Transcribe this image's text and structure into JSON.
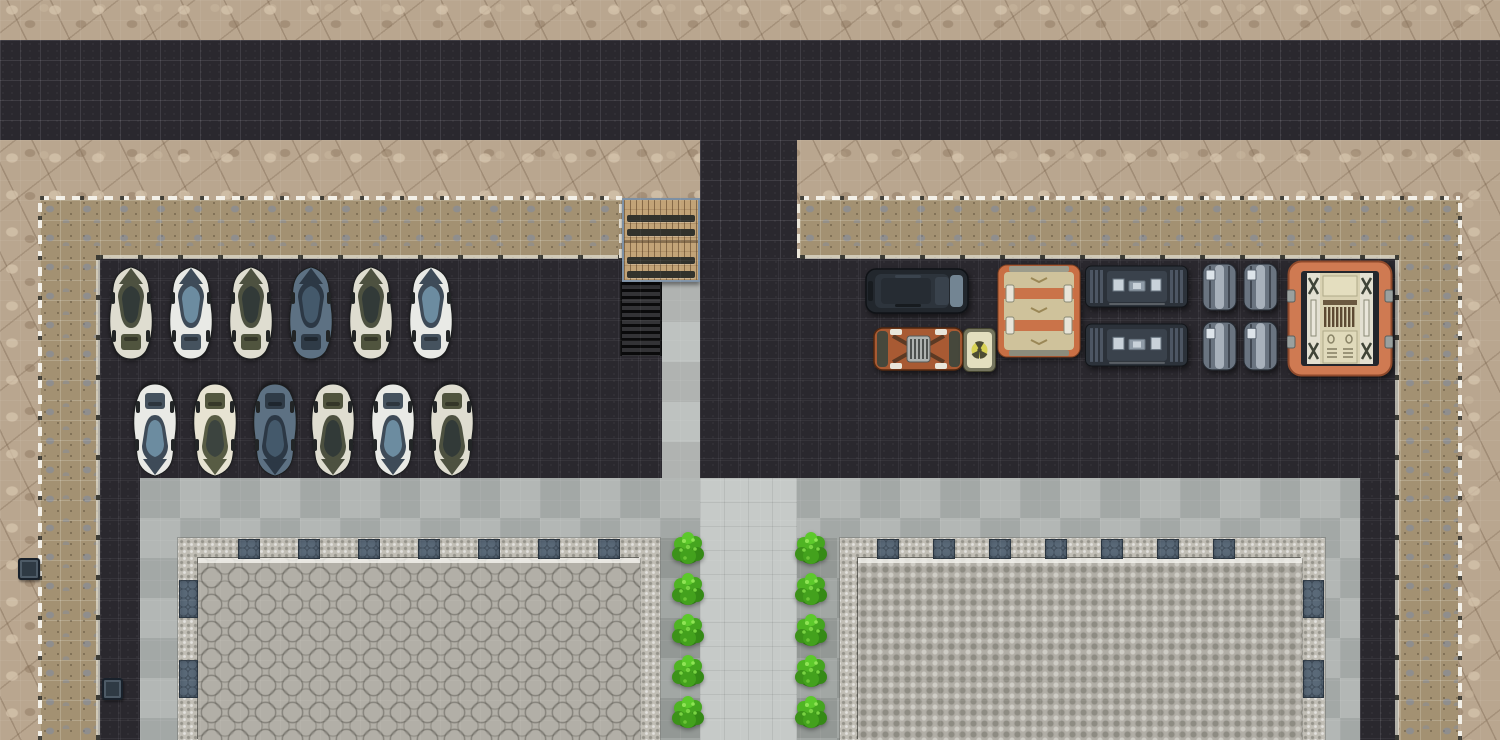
{
  "meta": {
    "view": "top-down-tile-map",
    "canvas_w": 1500,
    "canvas_h": 740,
    "tile_px": 20
  },
  "palette": {
    "rock": "#b9a68f",
    "asphalt": "#2a282e",
    "gravel": "#a39172",
    "plaza_concrete": "#acb1af",
    "walkway": "#c6cac8",
    "bush_strip": "#9ca29e",
    "deck_border": "#c1beb5",
    "hex_platform": "#b2afa7",
    "accent_tile": "#5a6978",
    "fence_white": "#f3f0e8",
    "bridge_wood": "#c2a377",
    "bush_green": "#46a81f",
    "car_themes": {
      "olive": {
        "body": "#dfddd0",
        "nose": "#4d5140",
        "canopy": "#4d5140",
        "glass": "#323a38",
        "rear": "#50543e"
      },
      "white_blue": {
        "body": "#e9eae6",
        "nose": "#3e4b58",
        "canopy": "#3e4b58",
        "glass": "#6c8ca0",
        "rear": "#45525e"
      },
      "dark_blue": {
        "body": "#5d7183",
        "nose": "#2c3845",
        "canopy": "#2c3845",
        "glass": "#44596b",
        "rear": "#2f3b47"
      },
      "cream_olive": {
        "body": "#e7e3d2",
        "nose": "#585c44",
        "canopy": "#585c44",
        "glass": "#3c443f",
        "rear": "#53573f"
      }
    },
    "van": {
      "body": "#22272d",
      "panel": "#2d343c",
      "glass": "#8fa6b6"
    },
    "cart": {
      "body": "#a85a33",
      "caps": "#46483c",
      "grille": "#aeb2b0",
      "pads": "#e9e6da"
    },
    "crate": {
      "frame": "#76765f",
      "face": "#e3dfbf",
      "symbol": "#d6d049"
    },
    "canvas_container": {
      "frame": "#c96f44",
      "canvas": "#cfc29b",
      "buckle": "#e8e4d8"
    },
    "trailer": {
      "body": "#2c323a",
      "ribs": "#4d5663",
      "panel": "#3a424c",
      "window": "#c9d2da"
    },
    "barrels": {
      "body": "#6a7480",
      "sheen": "#e6eef6",
      "port": "#dde4ea"
    },
    "orange_container": {
      "frame": "#cf7a52",
      "inner": "#23262c",
      "panel": "#d9d2b2",
      "rail": "#e3e0d2",
      "ribs": "#5d4a33",
      "tab": "#9aa09e"
    }
  },
  "terrain": [
    {
      "name": "rock-terrain",
      "surface": "rock",
      "x": 0,
      "y": 0,
      "w": 1500,
      "h": 740
    },
    {
      "name": "top-road",
      "surface": "asphalt",
      "x": 0,
      "y": 40,
      "w": 1500,
      "h": 100
    },
    {
      "name": "center-road",
      "surface": "asphalt",
      "x": 700,
      "y": 140,
      "w": 97,
      "h": 120
    },
    {
      "name": "gravel-path-top-left",
      "surface": "gravel",
      "x": 40,
      "y": 200,
      "w": 582,
      "h": 58
    },
    {
      "name": "gravel-path-top-right",
      "surface": "gravel",
      "x": 800,
      "y": 200,
      "w": 660,
      "h": 58
    },
    {
      "name": "gravel-path-left",
      "surface": "gravel",
      "x": 40,
      "y": 200,
      "w": 58,
      "h": 540
    },
    {
      "name": "gravel-path-right",
      "surface": "gravel",
      "x": 1400,
      "y": 200,
      "w": 58,
      "h": 540
    },
    {
      "name": "compound-asphalt",
      "surface": "asphalt",
      "x": 98,
      "y": 258,
      "w": 1300,
      "h": 220
    },
    {
      "name": "asphalt-margin-left",
      "surface": "asphalt",
      "x": 98,
      "y": 478,
      "w": 42,
      "h": 262
    },
    {
      "name": "asphalt-margin-right",
      "surface": "asphalt",
      "x": 1360,
      "y": 478,
      "w": 38,
      "h": 262
    },
    {
      "name": "plaza-concrete",
      "surface": "plaza",
      "x": 140,
      "y": 478,
      "w": 1220,
      "h": 262
    },
    {
      "name": "central-walkway",
      "surface": "walkway",
      "x": 700,
      "y": 478,
      "w": 97,
      "h": 262
    },
    {
      "name": "stair-landing",
      "surface": "landing",
      "x": 662,
      "y": 282,
      "w": 38,
      "h": 196
    },
    {
      "name": "stairs-down",
      "surface": "stairs",
      "x": 620,
      "y": 282,
      "w": 42,
      "h": 74
    },
    {
      "name": "planter-strip-left",
      "surface": "bushstrip",
      "x": 660,
      "y": 538,
      "w": 40,
      "h": 202
    },
    {
      "name": "planter-strip-right",
      "surface": "bushstrip",
      "x": 797,
      "y": 538,
      "w": 43,
      "h": 202
    },
    {
      "name": "hex-deck-left",
      "surface": "deckborder",
      "x": 178,
      "y": 538,
      "w": 482,
      "h": 202
    },
    {
      "name": "hex-platform-left",
      "surface": "hexplatform",
      "x": 198,
      "y": 558,
      "w": 442,
      "h": 182
    },
    {
      "name": "hex-deck-right",
      "surface": "deckborder",
      "x": 840,
      "y": 538,
      "w": 485,
      "h": 202
    },
    {
      "name": "hex-platform-right",
      "surface": "dotplatform",
      "x": 858,
      "y": 558,
      "w": 444,
      "h": 182
    }
  ],
  "fences": {
    "outer": [
      {
        "dir": "h",
        "x": 40,
        "y": 196,
        "len": 582
      },
      {
        "dir": "h",
        "x": 800,
        "y": 196,
        "len": 660
      },
      {
        "dir": "v",
        "x": 38,
        "y": 196,
        "len": 544
      },
      {
        "dir": "v",
        "x": 1458,
        "y": 196,
        "len": 544
      }
    ],
    "inner": [
      {
        "dir": "h",
        "x": 98,
        "y": 255,
        "len": 524
      },
      {
        "dir": "h",
        "x": 800,
        "y": 255,
        "len": 598
      },
      {
        "dir": "v",
        "x": 96,
        "y": 255,
        "len": 485
      },
      {
        "dir": "v",
        "x": 1395,
        "y": 255,
        "len": 485
      }
    ],
    "gates": [
      {
        "x": 619,
        "y": 198,
        "len": 60
      },
      {
        "x": 797,
        "y": 198,
        "len": 60
      }
    ]
  },
  "bridge": {
    "x": 622,
    "y": 198,
    "w": 78,
    "h": 84,
    "bars_rel_y": [
      15,
      29,
      57,
      71
    ],
    "split_rel_y": 40
  },
  "deck_accents": [
    {
      "x": 238,
      "y": 539,
      "w": 22,
      "h": 20
    },
    {
      "x": 298,
      "y": 539,
      "w": 22,
      "h": 20
    },
    {
      "x": 358,
      "y": 539,
      "w": 22,
      "h": 20
    },
    {
      "x": 418,
      "y": 539,
      "w": 22,
      "h": 20
    },
    {
      "x": 478,
      "y": 539,
      "w": 22,
      "h": 20
    },
    {
      "x": 538,
      "y": 539,
      "w": 22,
      "h": 20
    },
    {
      "x": 598,
      "y": 539,
      "w": 22,
      "h": 20
    },
    {
      "x": 179,
      "y": 580,
      "w": 19,
      "h": 38
    },
    {
      "x": 179,
      "y": 660,
      "w": 19,
      "h": 38
    },
    {
      "x": 877,
      "y": 539,
      "w": 22,
      "h": 20
    },
    {
      "x": 933,
      "y": 539,
      "w": 22,
      "h": 20
    },
    {
      "x": 989,
      "y": 539,
      "w": 22,
      "h": 20
    },
    {
      "x": 1045,
      "y": 539,
      "w": 22,
      "h": 20
    },
    {
      "x": 1101,
      "y": 539,
      "w": 22,
      "h": 20
    },
    {
      "x": 1157,
      "y": 539,
      "w": 22,
      "h": 20
    },
    {
      "x": 1213,
      "y": 539,
      "w": 22,
      "h": 20
    },
    {
      "x": 1303,
      "y": 580,
      "w": 21,
      "h": 38
    },
    {
      "x": 1303,
      "y": 660,
      "w": 21,
      "h": 38
    }
  ],
  "props": [
    {
      "name": "utility-box",
      "x": 18,
      "y": 558,
      "w": 22,
      "h": 22
    },
    {
      "name": "utility-box",
      "x": 102,
      "y": 678,
      "w": 21,
      "h": 22
    }
  ],
  "vegetation": {
    "bush_columns_x": [
      672,
      795
    ],
    "bush_rows_y": [
      531,
      572,
      613,
      654,
      695
    ],
    "bush_w": 32,
    "bush_h": 36
  },
  "vehicles": {
    "car_w": 52,
    "car_h": 97,
    "car_rows": [
      {
        "facing": "up",
        "y": 264,
        "cars": [
          {
            "x": 105,
            "theme": "olive"
          },
          {
            "x": 165,
            "theme": "white_blue"
          },
          {
            "x": 225,
            "theme": "olive"
          },
          {
            "x": 285,
            "theme": "dark_blue"
          },
          {
            "x": 345,
            "theme": "olive"
          },
          {
            "x": 405,
            "theme": "white_blue"
          }
        ]
      },
      {
        "facing": "down",
        "y": 382,
        "cars": [
          {
            "x": 129,
            "theme": "white_blue"
          },
          {
            "x": 189,
            "theme": "cream_olive"
          },
          {
            "x": 249,
            "theme": "dark_blue"
          },
          {
            "x": 307,
            "theme": "olive"
          },
          {
            "x": 367,
            "theme": "white_blue"
          },
          {
            "x": 426,
            "theme": "olive"
          }
        ]
      }
    ],
    "convoy": [
      {
        "type": "van",
        "name": "black-van",
        "x": 865,
        "y": 266,
        "w": 105,
        "h": 50
      },
      {
        "type": "cart",
        "name": "orange-cart",
        "x": 873,
        "y": 324,
        "w": 91,
        "h": 50
      },
      {
        "type": "crate",
        "name": "radiation-crate",
        "x": 963,
        "y": 328,
        "w": 33,
        "h": 44
      },
      {
        "type": "canvas_container",
        "name": "strapped-cargo-container",
        "x": 997,
        "y": 264,
        "w": 84,
        "h": 94
      },
      {
        "type": "trailer",
        "name": "armored-trailer",
        "x": 1085,
        "y": 264,
        "w": 103,
        "h": 45
      },
      {
        "type": "trailer",
        "name": "armored-trailer",
        "x": 1085,
        "y": 322,
        "w": 103,
        "h": 46
      },
      {
        "type": "barrels",
        "name": "metal-barrel-pair",
        "x": 1202,
        "y": 262,
        "w": 76,
        "h": 50
      },
      {
        "type": "barrels",
        "name": "metal-barrel-pair",
        "x": 1202,
        "y": 320,
        "w": 76,
        "h": 52
      },
      {
        "type": "orange_container",
        "name": "orange-cargo-container",
        "x": 1287,
        "y": 260,
        "w": 106,
        "h": 117
      }
    ]
  }
}
